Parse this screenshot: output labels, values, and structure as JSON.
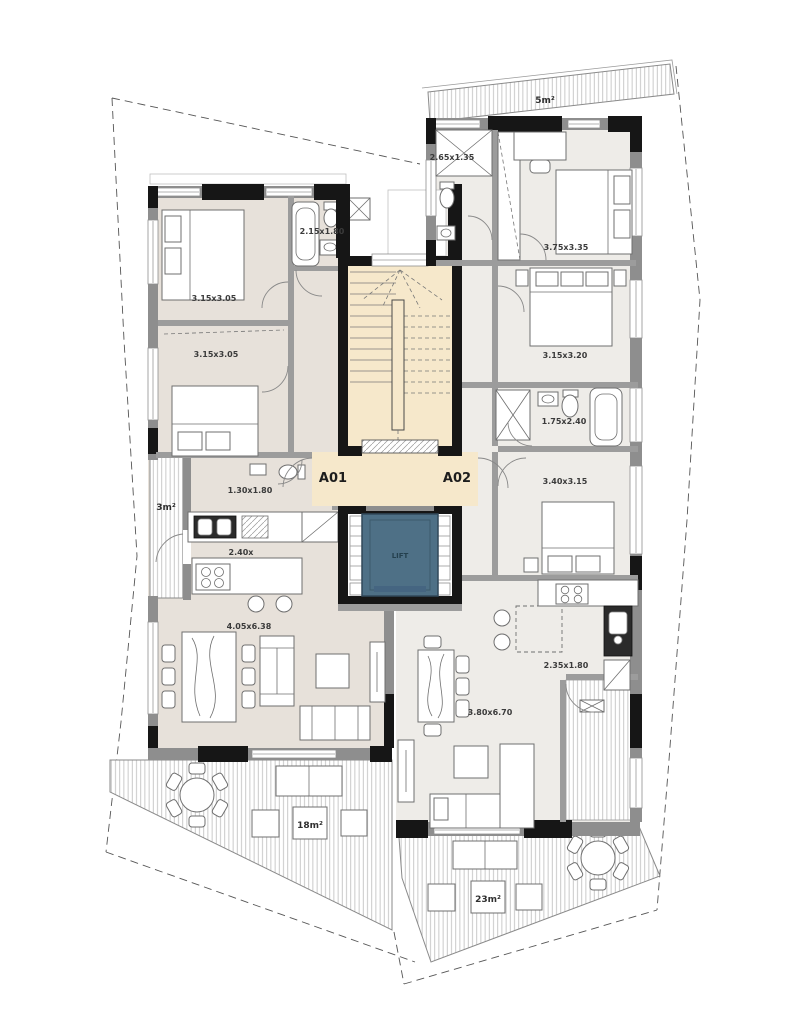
{
  "plan": {
    "lift_label": "LIFT",
    "a01": {
      "label": "A01",
      "bedroom1": "3.15x3.05",
      "bedroom2": "3.15x3.05",
      "bathroom": "2.15x1.80",
      "wc": "1.30x1.80",
      "kitchen": "2.40x",
      "living": "4.05x6.38",
      "side_balcony": "3m²",
      "terrace": "18m²"
    },
    "a02": {
      "label": "A02",
      "shower_room": "2.65x1.35",
      "bedroom1": "3.75x3.35",
      "bedroom2": "3.15x3.20",
      "bathroom": "1.75x2.40",
      "bedroom3": "3.40x3.15",
      "kitchen": "2.35x1.80",
      "living": "3.80x6.70",
      "top_balcony": "5m²",
      "terrace": "23m²"
    },
    "colors": {
      "a01_floor": "#e7e1da",
      "a02_floor": "#eeece8",
      "core_floor": "#f6e8cb",
      "lift_cabin": "#4e7086",
      "wall": "#161616"
    }
  }
}
